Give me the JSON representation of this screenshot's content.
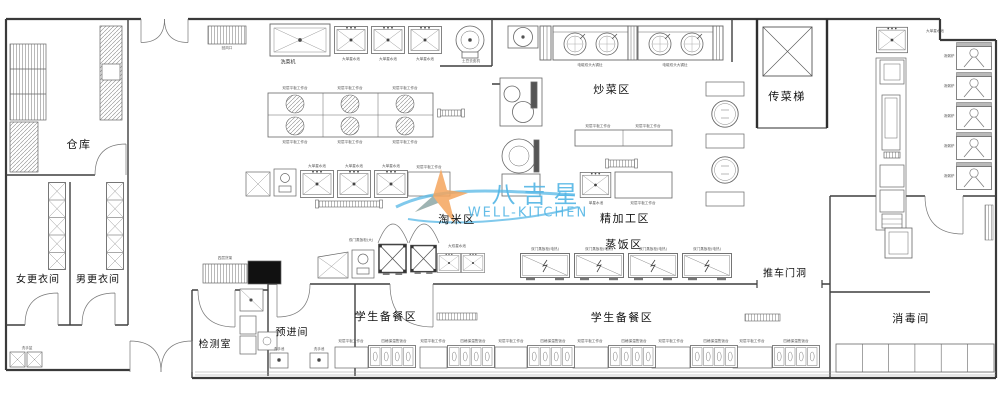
{
  "watermark": {
    "brand_cn": "八吉星",
    "brand_en": "WELL-KITCHEN",
    "text_color": "#56b7e6",
    "star_color": "#f4a45d"
  },
  "rooms": {
    "warehouse": "仓库",
    "women_changing": "女更衣间",
    "men_changing": "男更衣间",
    "inspection_room": "检测室",
    "pre_entry_room": "预进间",
    "rice_washing_zone": "淘米区",
    "stir_fry_zone": "炒菜区",
    "dish_elevator": "传菜梯",
    "fine_processing_zone": "精加工区",
    "rice_steaming_zone": "蒸饭区",
    "student_serving_zone_1": "学生备餐区",
    "student_serving_zone_2": "学生备餐区",
    "cart_door_opening": "推车门洞",
    "disinfection_room": "消毒间"
  },
  "equipment": {
    "vegetable_washer": "洗菜机",
    "single_sink": "大单星水池",
    "double_sink": "大双星水池",
    "potato_peeler": "土豆去皮机",
    "wok_range": "电磁双头大锅灶",
    "flat_worktable": "双层平板工作台",
    "steam_cabinet": "双门蒸饭柜(电热)",
    "steam_cabinet_large": "双门蒸饭柜(大)",
    "food_warmer": "四格保温售饭台",
    "hand_sink": "洗手池",
    "hand_basin": "洗手盆",
    "single_sink_table": "单星水池",
    "soup_stove": "汤粥炉",
    "rack": "四层货架",
    "air_vent": "回风口"
  }
}
